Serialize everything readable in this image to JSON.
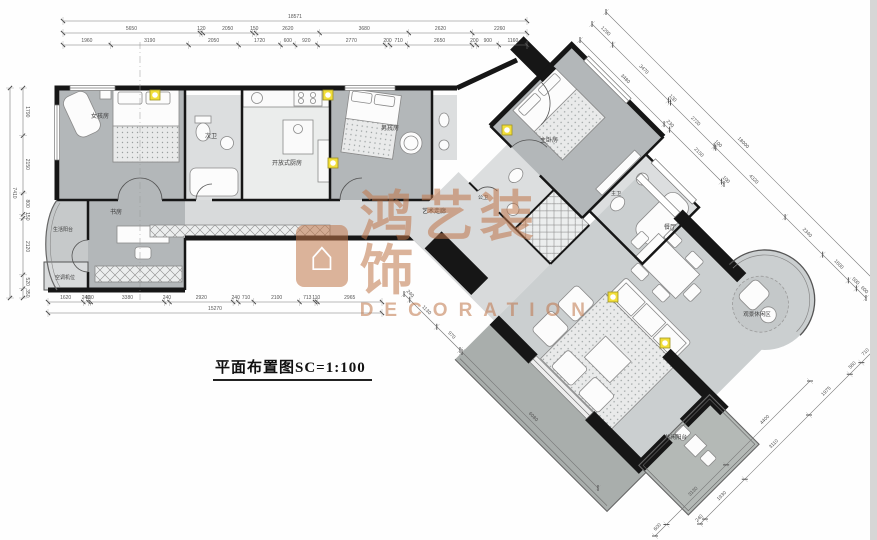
{
  "title": {
    "text": "平面布置图SC=1:100"
  },
  "watermark": {
    "cn": "鸿艺装饰",
    "en": "DECORATION",
    "logo_glyph": "⌂"
  },
  "rooms": {
    "bedroom_girl": "女孩房",
    "bath_second": "次卫",
    "kitchen": "开放式厨房",
    "bedroom_boy": "男孩房",
    "study": "书房",
    "balcony_service": "生活阳台",
    "ac_unit": "空调机位",
    "corridor": "艺术走廊",
    "bath_guest": "公卫",
    "master_bedroom": "主卧房",
    "master_bath": "主卫",
    "dining": "餐厅",
    "bay_lounge": "观景休闲区",
    "balcony_leisure": "休闲阳台"
  },
  "dims": {
    "top_total": [
      "18571"
    ],
    "top_row2": [
      "5650",
      "120",
      "2050",
      "150",
      "2620",
      "3680",
      "2620",
      "2260"
    ],
    "top_row3": [
      "1960",
      "3190",
      "2050",
      "1720",
      "600",
      "920",
      "2770",
      "200",
      "710",
      "2650",
      "200",
      "900",
      "1160"
    ],
    "left_total": [
      "7410"
    ],
    "left_parts": [
      "1790",
      "2150",
      "800",
      "150",
      "2120",
      "520",
      "350"
    ],
    "bottom_parts": [
      "1620",
      "240",
      "100",
      "3380",
      "240",
      "2920",
      "240",
      "710",
      "2100",
      "713",
      "110",
      "2965"
    ],
    "bottom_total": [
      "15270"
    ],
    "ne_total": [
      "18000"
    ],
    "ne_outer": [
      "1290",
      "3470",
      "130",
      "2720",
      "100",
      "4320",
      "2340",
      "1600",
      "500",
      "600"
    ],
    "ne_inner": [
      "3480",
      "230",
      "2150",
      "100"
    ],
    "se_outer": [
      "240",
      "1930",
      "3110",
      "1975",
      "560",
      "710"
    ],
    "se_inner": [
      "600",
      "3130",
      "4400"
    ],
    "sw_small": [
      "240",
      "1130",
      "970"
    ],
    "sw_long": [
      "6080"
    ]
  },
  "colors": {
    "wall": "#161616",
    "room_dark": "#b3b7b9",
    "room_light": "#dcdedf",
    "corridor": "#d8dadb",
    "living": "#cbcfd0",
    "balcony_dark": "#a9aeac",
    "accent_yellow": "#f2df3a",
    "dim_line": "#777777",
    "watermark": "#c0764a"
  }
}
